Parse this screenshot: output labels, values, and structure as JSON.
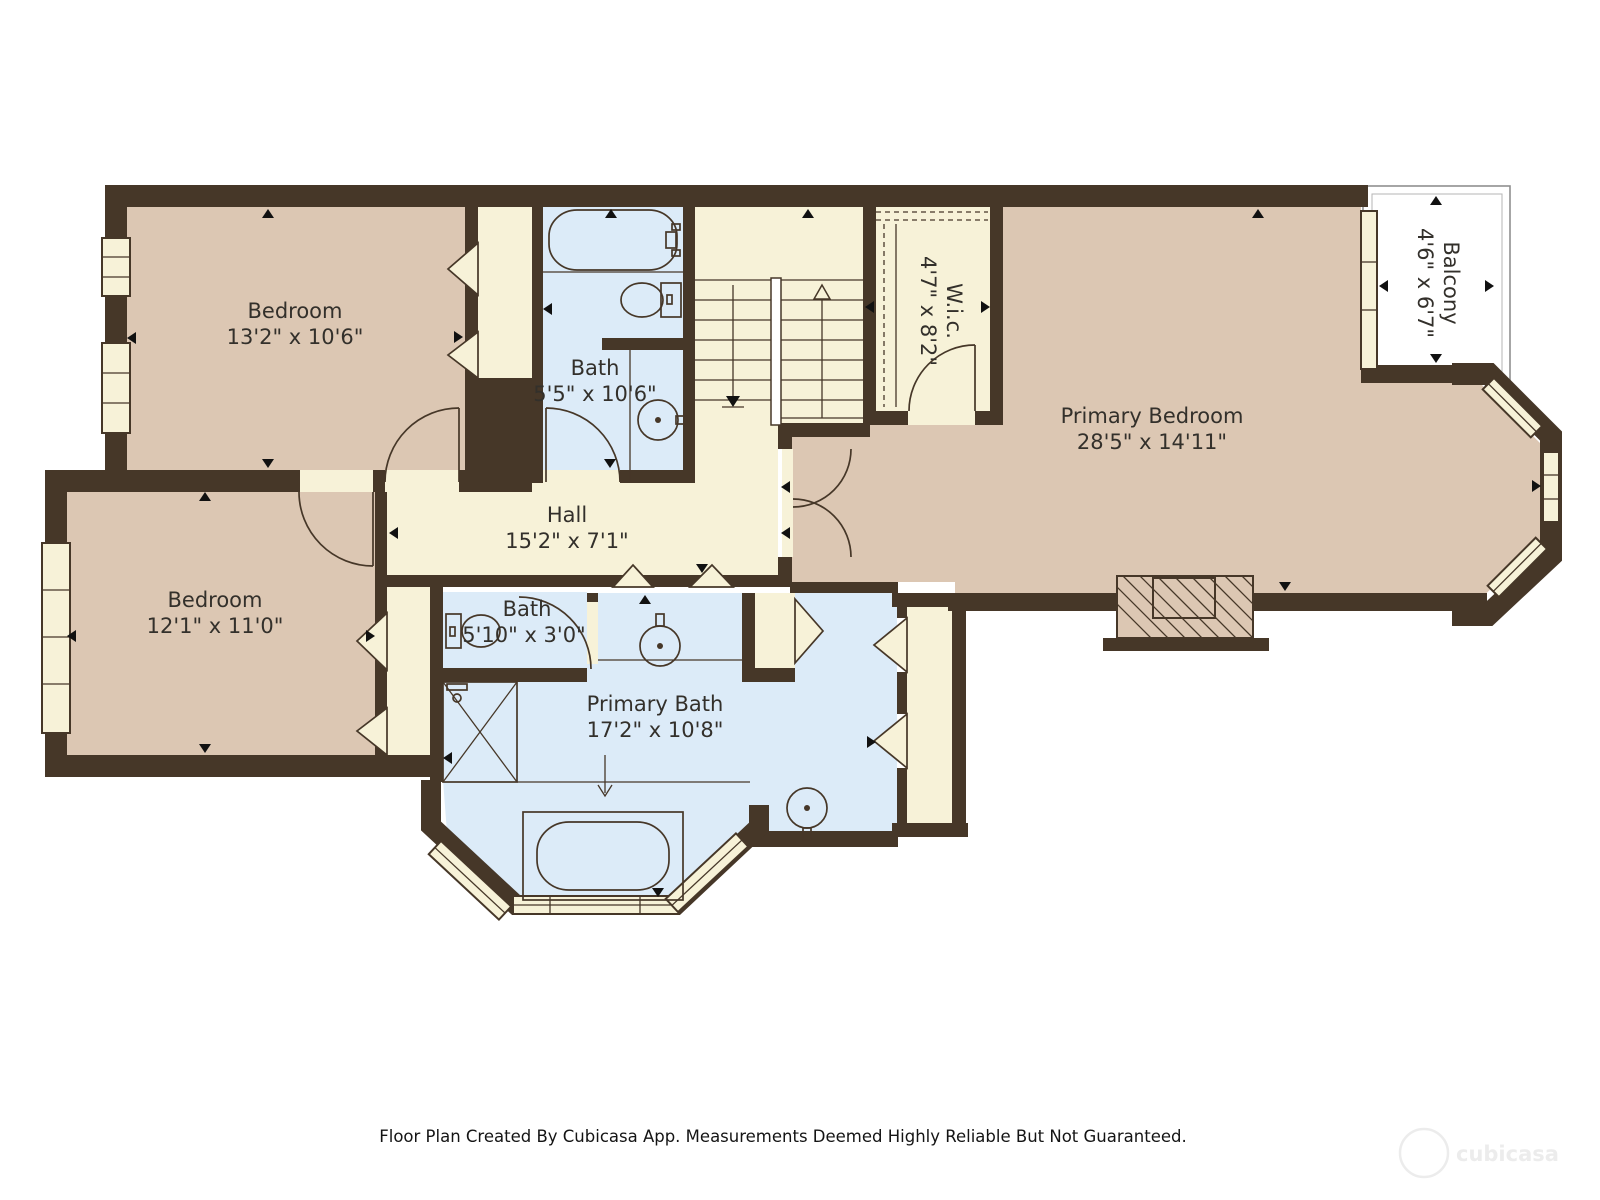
{
  "plan": {
    "rooms": {
      "bedroom1": {
        "name": "Bedroom",
        "dims": "13'2\" x 10'6\""
      },
      "bedroom2": {
        "name": "Bedroom",
        "dims": "12'1\" x 11'0\""
      },
      "bath1": {
        "name": "Bath",
        "dims": "5'5\" x 10'6\""
      },
      "bath2": {
        "name": "Bath",
        "dims": "5'10\" x 3'0\""
      },
      "primary_bath": {
        "name": "Primary Bath",
        "dims": "17'2\" x 10'8\""
      },
      "primary_bedroom": {
        "name": "Primary Bedroom",
        "dims": "28'5\" x 14'11\""
      },
      "hall": {
        "name": "Hall",
        "dims": "15'2\" x 7'1\""
      },
      "wic": {
        "name": "W.i.c.",
        "dims": "4'7\" x 8'2\""
      },
      "balcony": {
        "name": "Balcony",
        "dims": "4'6\" x 6'7\""
      }
    },
    "footer": "Floor Plan Created By Cubicasa App. Measurements Deemed Highly Reliable But Not Guaranteed.",
    "watermark": "cubicasa",
    "colors": {
      "wall": "#463728",
      "room_tan": "#dcc7b3",
      "dry_cream": "#f7f2d8",
      "wet_blue": "#dcebf8",
      "balcony_white": "#ffffff",
      "label_text": "#33302b"
    }
  }
}
